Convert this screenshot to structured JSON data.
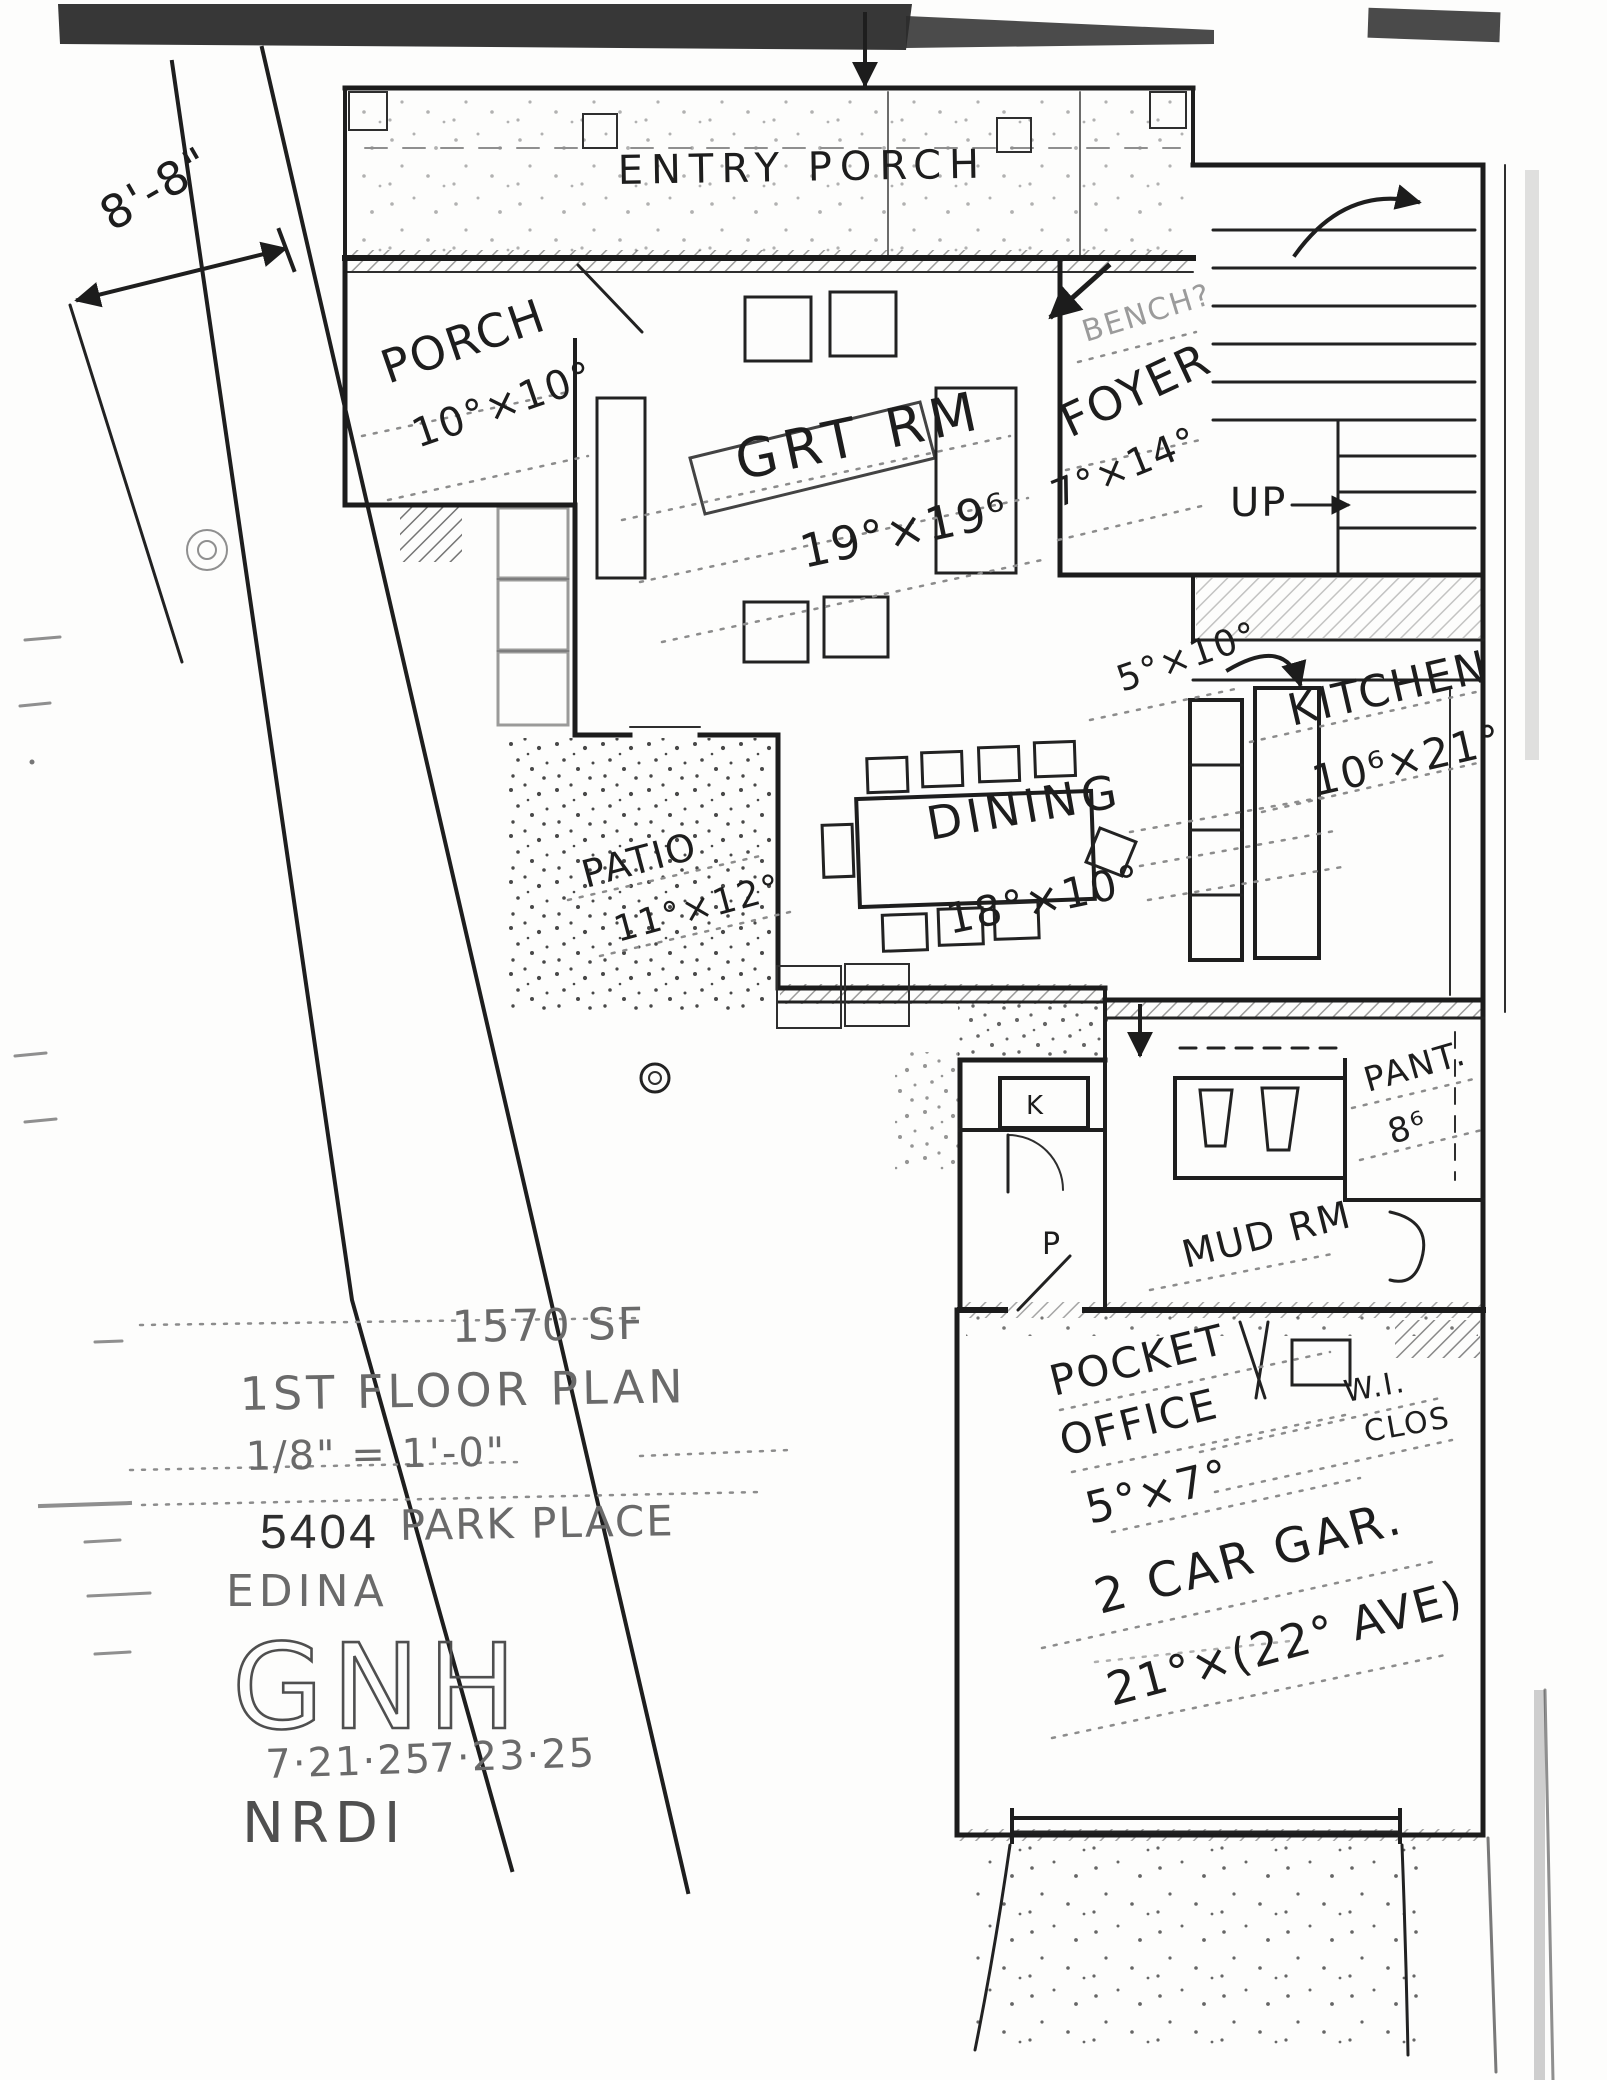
{
  "site": {
    "offset_dimension": "8'-8\""
  },
  "rooms": {
    "entry_porch": {
      "name": "ENTRY PORCH"
    },
    "porch": {
      "name": "PORCH",
      "dims": "10°×10°"
    },
    "foyer": {
      "name": "FOYER",
      "dims": "7°×14°",
      "note": "BENCH?"
    },
    "great_room": {
      "name": "GRT RM",
      "dims": "19°×19⁶"
    },
    "stairs": {
      "label": "UP"
    },
    "kitchen": {
      "name": "KITCHEN",
      "dims": "10⁶×21°",
      "island_dims": "5°×10°"
    },
    "dining": {
      "name": "DINING",
      "dims": "18°×10°"
    },
    "patio": {
      "name": "PATIO",
      "dims": "11°×12°"
    },
    "pantry": {
      "name": "PANT.",
      "dims": "8⁶"
    },
    "mud_room": {
      "name": "MUD RM"
    },
    "pocket_office": {
      "line1": "POCKET",
      "line2": "OFFICE",
      "dims": "5°×7°"
    },
    "walk_in_closet": {
      "line1": "W.I.",
      "line2": "CLOS"
    },
    "garage": {
      "name": "2 CAR GAR.",
      "dims": "21°×(22° AVE)"
    },
    "marks": {
      "k": "K",
      "p": "P"
    }
  },
  "title_block": {
    "area": "1570 SF",
    "plan_title": "1ST FLOOR PLAN",
    "scale": "1/8\" = 1'-0\"",
    "address_number": "5404",
    "address_street": "PARK PLACE",
    "city": "EDINA",
    "monogram": "GNH",
    "date_first": "7·21·25",
    "date_second": "7·23·25",
    "initials": "NRDI"
  }
}
